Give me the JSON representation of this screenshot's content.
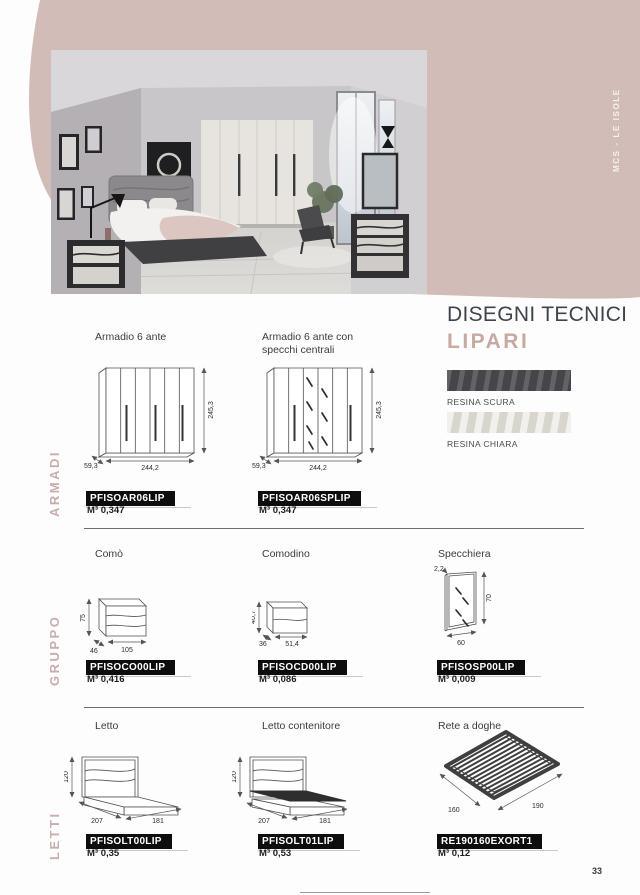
{
  "page": {
    "number": "33",
    "side_label": "MCS - LE ISOLE"
  },
  "header": {
    "title": "DISEGNI TECNICI",
    "collection": "LIPARI"
  },
  "finishes": {
    "items": [
      {
        "label": "RESINA SCURA",
        "color": "#56555a"
      },
      {
        "label": "RESINA CHIARA",
        "color": "#e1ded5"
      }
    ]
  },
  "colors": {
    "accent_mauve": "#c8aca6",
    "blob": "#d2bcb7",
    "code_bar_bg": "#0d0d0d",
    "divider": "#6e6e6e"
  },
  "sections": [
    {
      "label": "ARMADI",
      "products": [
        {
          "name": "Armadio 6 ante",
          "code": "PFISOAR06LIP",
          "volume": "M³ 0,347",
          "dims": {
            "h": "245,3",
            "w": "244,2",
            "d": "59,3"
          }
        },
        {
          "name": "Armadio 6 ante con specchi centrali",
          "code": "PFISOAR06SPLIP",
          "volume": "M³ 0,347",
          "dims": {
            "h": "245,3",
            "w": "244,2",
            "d": "59,3"
          }
        }
      ]
    },
    {
      "label": "GRUPPO",
      "products": [
        {
          "name": "Comò",
          "code": "PFISOCO00LIP",
          "volume": "M³ 0,416",
          "dims": {
            "h": "75",
            "w": "105",
            "d": "46"
          }
        },
        {
          "name": "Comodino",
          "code": "PFISOCD00LIP",
          "volume": "M³ 0,086",
          "dims": {
            "h": "40,7",
            "w": "51,4",
            "d": "36"
          }
        },
        {
          "name": "Specchiera",
          "code": "PFISOSP00LIP",
          "volume": "M³ 0,009",
          "dims": {
            "h": "70",
            "w": "60",
            "d": "2,2"
          }
        }
      ]
    },
    {
      "label": "LETTI",
      "products": [
        {
          "name": "Letto",
          "code": "PFISOLT00LIP",
          "volume": "M³ 0,35",
          "dims": {
            "h": "120",
            "w": "181",
            "d": "207"
          }
        },
        {
          "name": "Letto contenitore",
          "code": "PFISOLT01LIP",
          "volume": "M³ 0,53",
          "dims": {
            "h": "120",
            "w": "181",
            "d": "207"
          }
        },
        {
          "name": "Rete a doghe",
          "code": "RE190160EXORT1",
          "volume": "M³ 0,12",
          "dims": {
            "w": "190",
            "d": "160"
          }
        }
      ]
    }
  ]
}
